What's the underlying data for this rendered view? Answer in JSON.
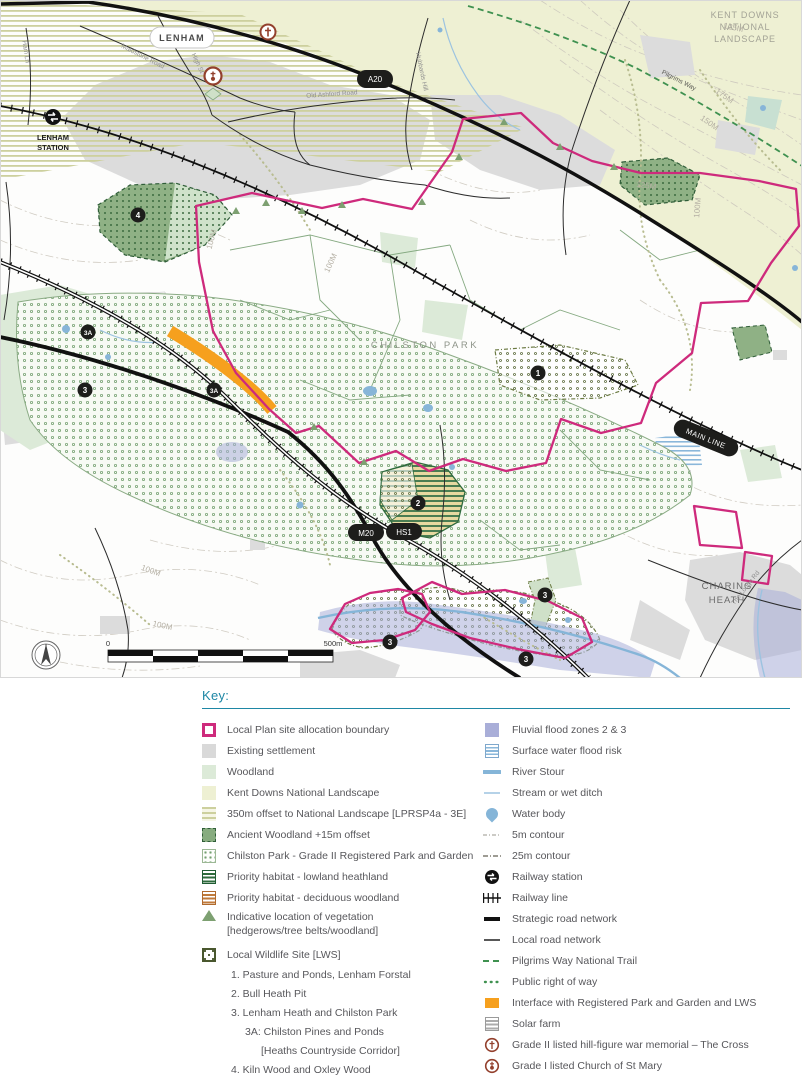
{
  "map": {
    "labels": {
      "lenham": "LENHAM",
      "lenham_station": [
        "LENHAM",
        "STATION"
      ],
      "kent_downs": [
        "KENT DOWNS",
        "NATIONAL",
        "LANDSCAPE"
      ],
      "chilston_park": "CHILSTON PARK",
      "charing_heath": [
        "CHARING",
        "HEATH"
      ]
    },
    "routes": {
      "a20": "A20",
      "m20": "M20",
      "hs1": "HS1",
      "main_line": "MAIN LINE",
      "pilgrims_way": "Pilgrims Way"
    },
    "roads": [
      "Maidstone Road",
      "High St",
      "Ham Ln",
      "Old Ashford Road",
      "Hubbards Hill",
      "The Lodge Rd"
    ],
    "contours": [
      "125M",
      "175M",
      "150M",
      "125M",
      "100M",
      "100M",
      "100M",
      "100M",
      "100M"
    ],
    "markers": [
      "4",
      "3A",
      "3",
      "3A",
      "1",
      "2",
      "3",
      "3",
      "3"
    ],
    "scale": {
      "start": "0",
      "end": "500m"
    }
  },
  "legend": {
    "title": "Key:",
    "left": [
      "Local Plan site allocation boundary",
      "Existing settlement",
      "Woodland",
      "Kent Downs National Landscape",
      "350m offset to National Landscape [LPRSP4a - 3E]",
      "Ancient Woodland +15m offset",
      "Chilston Park - Grade II Registered Park and Garden",
      "Priority habitat - lowland heathland",
      "Priority habitat - deciduous woodland",
      "Indicative location of vegetation",
      "[hedgerows/tree belts/woodland]",
      "Local Wildlife Site [LWS]"
    ],
    "lws_list": [
      "1. Pasture and Ponds, Lenham Forstal",
      "2. Bull Heath Pit",
      "3. Lenham Heath and Chilston Park",
      "3A: Chilston Pines and Ponds",
      "[Heaths Countryside Corridor]",
      "4. Kiln Wood and Oxley Wood"
    ],
    "right": [
      "Fluvial flood zones 2 & 3",
      "Surface water flood risk",
      "River Stour",
      "Stream or wet ditch",
      "Water body",
      "5m contour",
      "25m contour",
      "Railway station",
      "Railway line",
      "Strategic road network",
      "Local road network",
      "Pilgrims Way National Trail",
      "Public right of way",
      "Interface with Registered Park and Garden and LWS",
      "Solar farm",
      "Grade II listed hill-figure war memorial – The Cross",
      "Grade I listed Church of St Mary"
    ]
  },
  "colors": {
    "key_teal": "#1e87a5",
    "boundary_pink": "#ce2a7c",
    "interface_orange": "#f6a01e",
    "flood_purple": "#a9aed8",
    "water_blue": "#85b5d8",
    "woodland_green": "#dcead8",
    "kent_downs_yellow": "#eef0d3",
    "ancient_woodland_green": "#87ac7f",
    "settlement_grey": "#d9d9d9",
    "listed_building_red": "#93402d",
    "trail_green": "#3f9150"
  }
}
